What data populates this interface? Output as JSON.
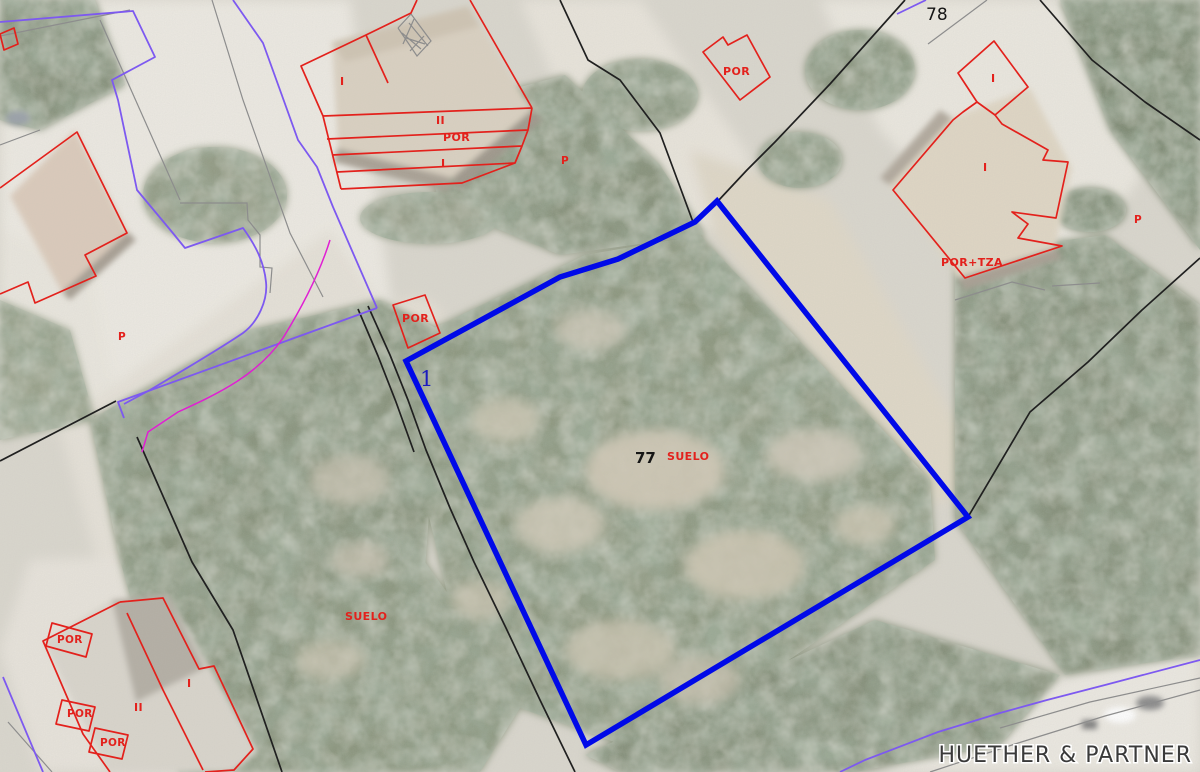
{
  "title": "Cadastral aerial map with highlighted parcel",
  "labels": {
    "parcel_78": "78",
    "parcel_77": "77",
    "suelo": "SUELO",
    "por": "POR",
    "por_tza": "POR+TZA",
    "floor_one": "I",
    "floor_two": "II",
    "p": "P",
    "marker_one": "1",
    "watermark": "HUETHER & PARTNER"
  },
  "colors": {
    "parcel_highlight_blue": "#0009e8",
    "cadastral_red": "#e3211c",
    "boundary_black": "#202020",
    "boundary_gray": "#8d8d8d",
    "boundary_purple": "#7d59f0",
    "boundary_magenta": "#e01fd3",
    "label_blue": "#1b1bbe",
    "label_black": "#161616"
  }
}
